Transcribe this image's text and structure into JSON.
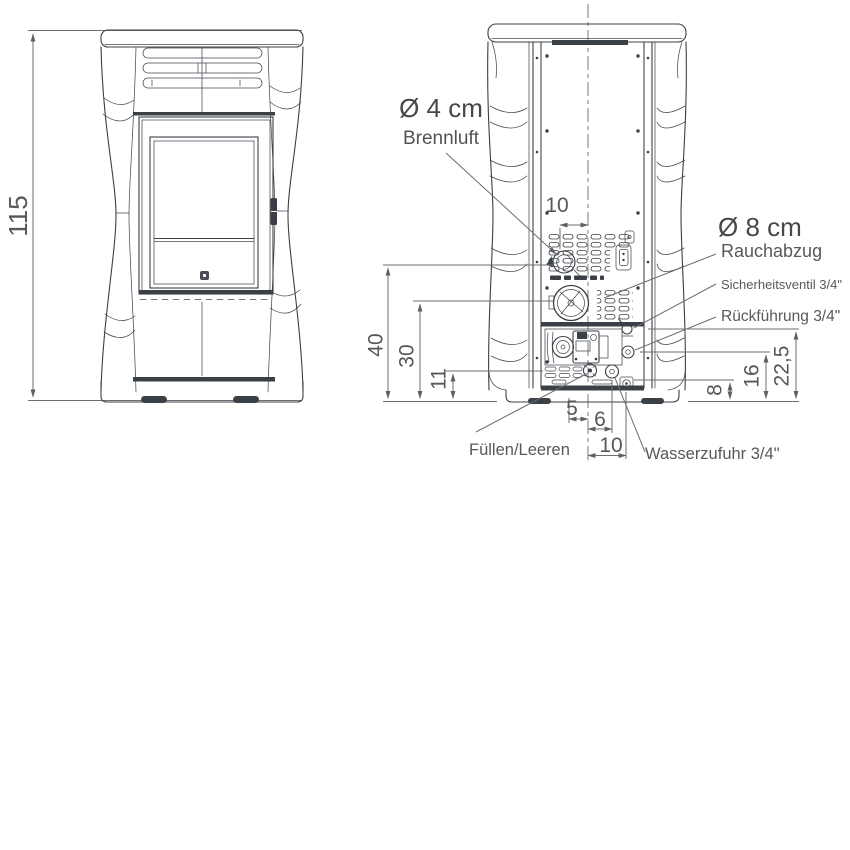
{
  "front": {
    "height": "115"
  },
  "rear": {
    "dims": {
      "top10": "10",
      "h40": "40",
      "h30": "30",
      "h11": "11",
      "b5": "5",
      "b6": "6",
      "b10": "10",
      "r8": "8",
      "r16": "16",
      "r225": "22,5"
    },
    "labels": {
      "brennluft_d": "Ø 4 cm",
      "brennluft": "Brennluft",
      "rauchabzug_d": "Ø 8 cm",
      "rauchabzug": "Rauchabzug",
      "sicherheitsventil": "Sicherheitsventil 3/4\"",
      "rueckfuehrung": "Rückführung 3/4\"",
      "fuellen": "Füllen/Leeren",
      "wasserzufuhr": "Wasserzufuhr 3/4\""
    }
  },
  "colors": {
    "line": "#3b4046",
    "dimension": "#6b6e72",
    "text": "#55585c",
    "background": "#ffffff"
  }
}
